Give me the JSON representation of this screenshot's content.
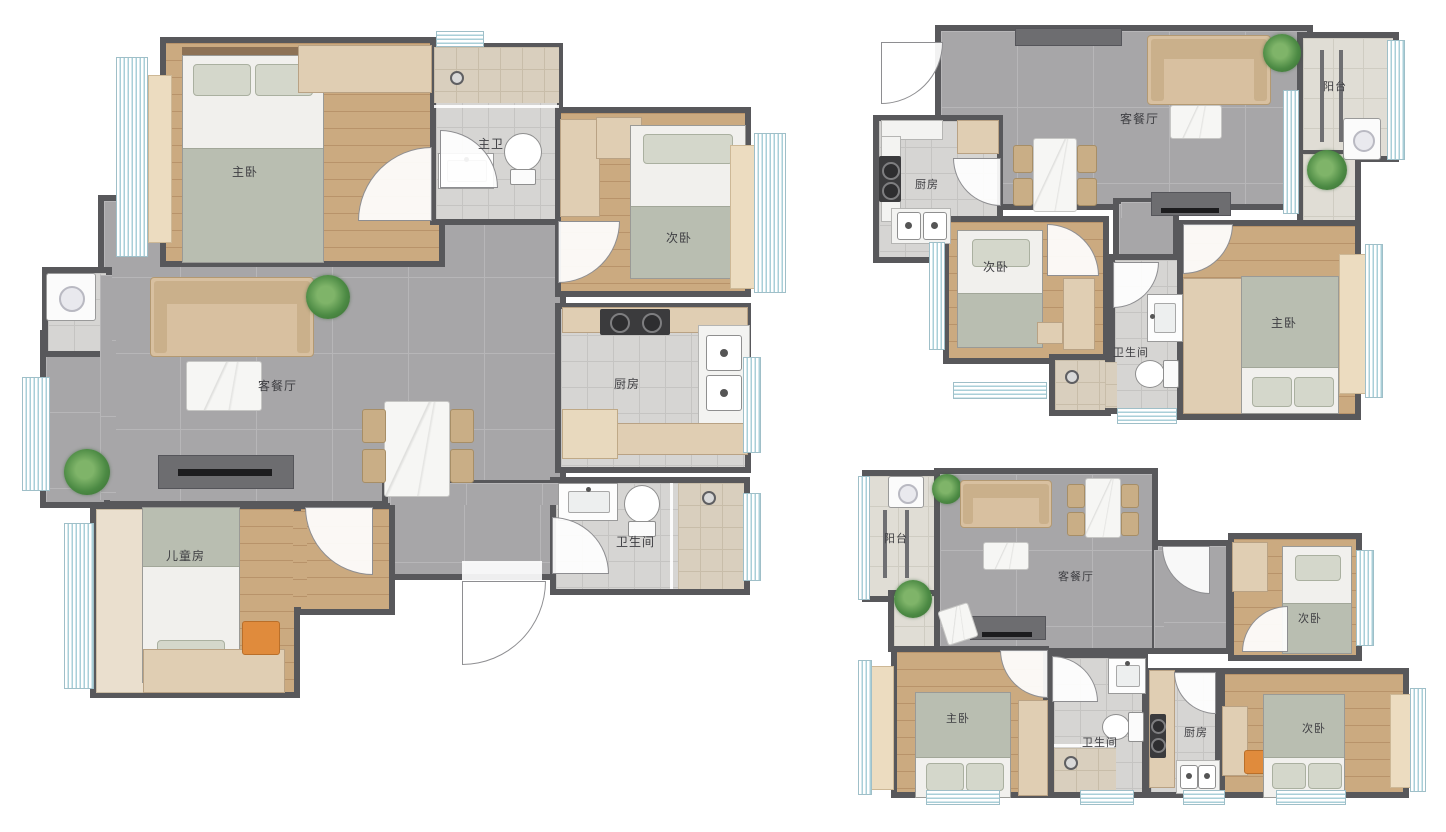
{
  "plans": {
    "a": {
      "name": "large-three-bedroom-plan",
      "rooms": {
        "master_bedroom": "主卧",
        "master_bath": "主卫",
        "second_bedroom": "次卧",
        "living_dining": "客餐厅",
        "kitchen": "厨房",
        "bathroom": "卫生间",
        "kids_room": "儿童房"
      }
    },
    "b": {
      "name": "top-right-two-bedroom-plan",
      "rooms": {
        "living_dining": "客餐厅",
        "kitchen": "厨房",
        "balcony": "阳台",
        "second_bedroom": "次卧",
        "bathroom": "卫生间",
        "master_bedroom": "主卧"
      }
    },
    "c": {
      "name": "bottom-right-three-bedroom-plan",
      "rooms": {
        "balcony": "阳台",
        "living_dining": "客餐厅",
        "second_bedroom_top": "次卧",
        "master_bedroom": "主卧",
        "bathroom": "卫生间",
        "kitchen": "厨房",
        "second_bedroom_bottom": "次卧"
      }
    }
  },
  "colors": {
    "wall": "#58585b",
    "wood_floor": "#cbaa80",
    "tile_gray": "#a7a6a8",
    "tile_light": "#d6d5d3",
    "tile_beige": "#d9cfbe",
    "balcony_tile": "#e0ddd5",
    "sofa": "#d8c0a0",
    "wardrobe": "#e0ceb3",
    "plant_green": "#4c8a44",
    "accent_orange": "#e08b3c",
    "window_blue": "#a9cfd8",
    "bed_blanket": "#b9beb1"
  }
}
